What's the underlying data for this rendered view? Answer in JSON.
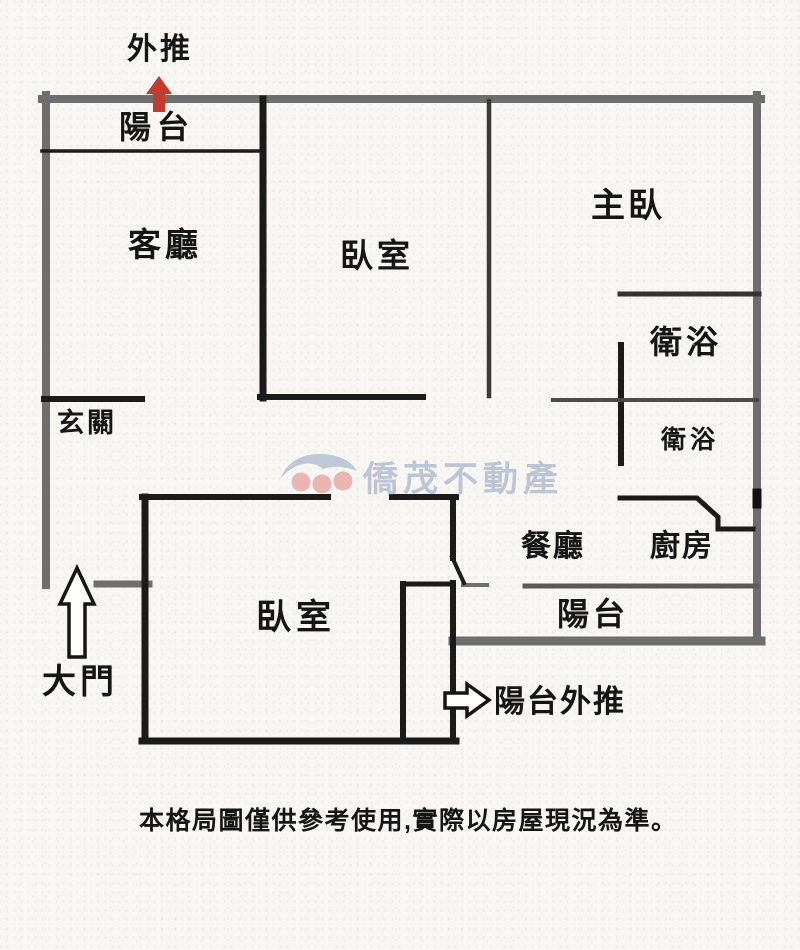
{
  "page": {
    "background_color": "#f7f6f2",
    "ink_color": "#1b1b1b",
    "outer_wall_color": "#6e6e6e",
    "accent_red": "#c43b2e",
    "watermark_text_color": "#b3bdd1",
    "watermark_dot_color": "#e9aba6"
  },
  "rooms": {
    "balcony_top": "陽台",
    "living_room": "客廳",
    "bedroom_upper": "臥室",
    "master_bedroom": "主臥",
    "bathroom_main": "衛浴",
    "bathroom_second": "衛浴",
    "entryway": "玄關",
    "dining_room": "餐廳",
    "kitchen": "廚房",
    "bedroom_lower": "臥室",
    "balcony_bottom": "陽台"
  },
  "annotations": {
    "push_out": "外推",
    "main_door": "大門",
    "balcony_push_out": "陽台外推"
  },
  "watermark": "僑茂不動產",
  "disclaimer": "本格局圖僅供參考使用,實際以房屋現況為準。"
}
